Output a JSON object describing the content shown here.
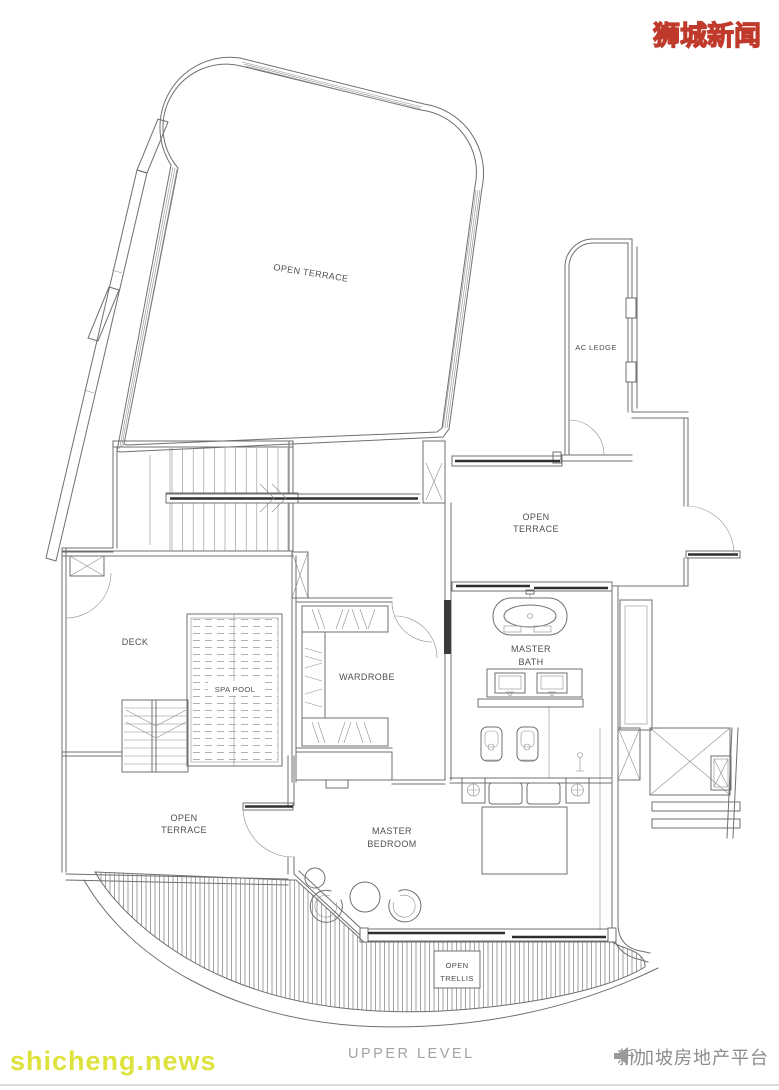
{
  "header": {
    "logo_text": "狮城新闻"
  },
  "plan": {
    "title": "UPPER LEVEL",
    "labels": {
      "open_terrace_top": "OPEN TERRACE",
      "ac_ledge": "AC LEDGE",
      "open_terrace_right_1": "OPEN",
      "open_terrace_right_2": "TERRACE",
      "master_bath_1": "MASTER",
      "master_bath_2": "BATH",
      "wardrobe": "WARDROBE",
      "deck": "DECK",
      "spa_pool": "SPA POOL",
      "open_terrace_lower_1": "OPEN",
      "open_terrace_lower_2": "TERRACE",
      "master_bedroom_1": "MASTER",
      "master_bedroom_2": "BEDROOM",
      "open_trellis_1": "OPEN",
      "open_trellis_2": "TRELLIS"
    }
  },
  "footer": {
    "watermark_left": "shicheng.news",
    "publisher": "新加坡房地产平台",
    "icon": "megaphone-icon"
  },
  "colors": {
    "logo_fill": "#f7ec34",
    "logo_outline": "#c03a2b",
    "watermark_yellow": "#dde23c",
    "level_title_gray": "#a3a3a3",
    "publisher_gray": "#8d8d8d",
    "plan_line": "#6f6f6f",
    "plan_dark_line": "#2f2f2f",
    "label_text": "#4f4f4f"
  }
}
